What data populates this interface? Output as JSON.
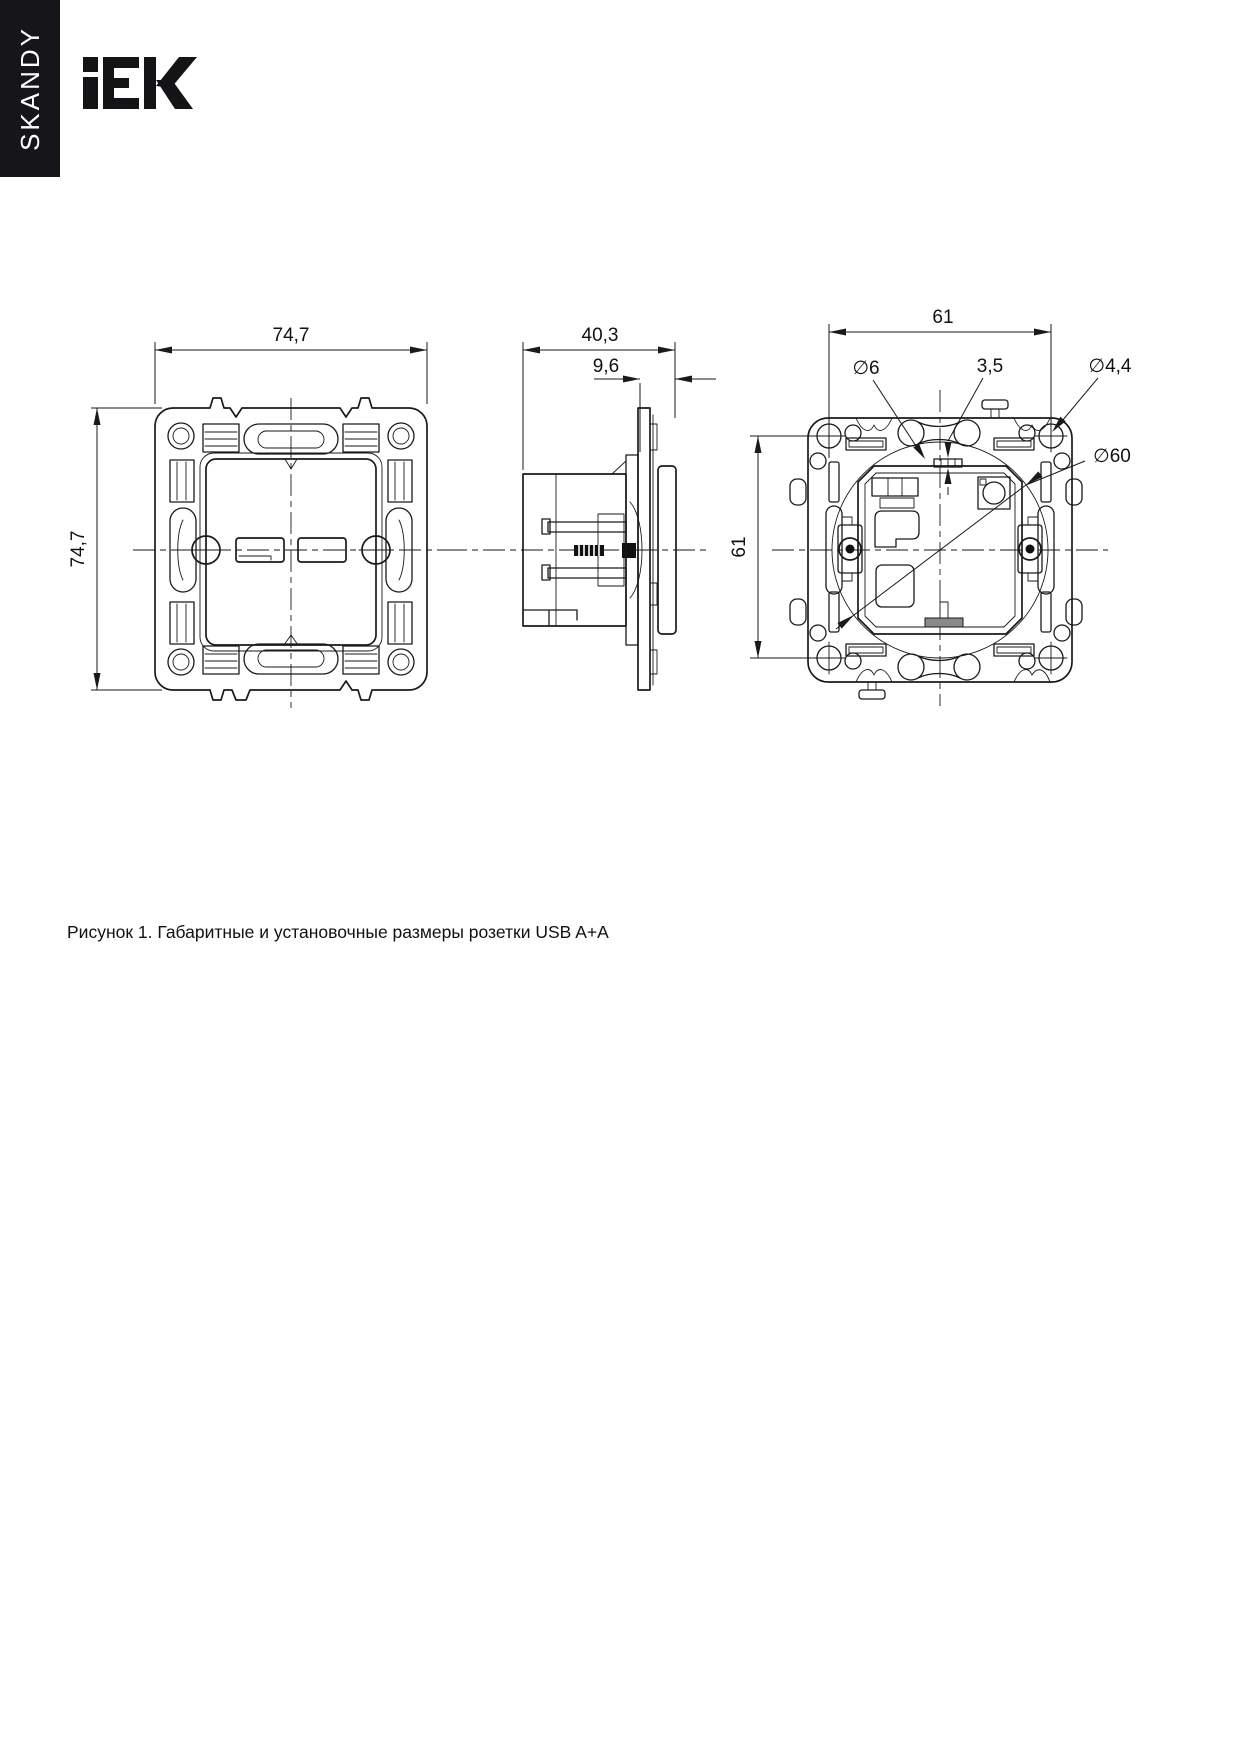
{
  "sidebar": {
    "series": "SKANDY"
  },
  "brand": {
    "name": "IEK"
  },
  "figure": {
    "caption": "Рисунок 1. Габаритные и установочные размеры розетки USB A+A",
    "front_view": {
      "width": "74,7",
      "height": "74,7"
    },
    "side_view": {
      "depth": "40,3",
      "protrusion": "9,6"
    },
    "back_view": {
      "mount_width": "61",
      "mount_height": "61",
      "slot_diameter": "∅6",
      "tab_width": "3,5",
      "screw_hole_diameter": "∅4,4",
      "box_diameter": "∅60"
    }
  }
}
